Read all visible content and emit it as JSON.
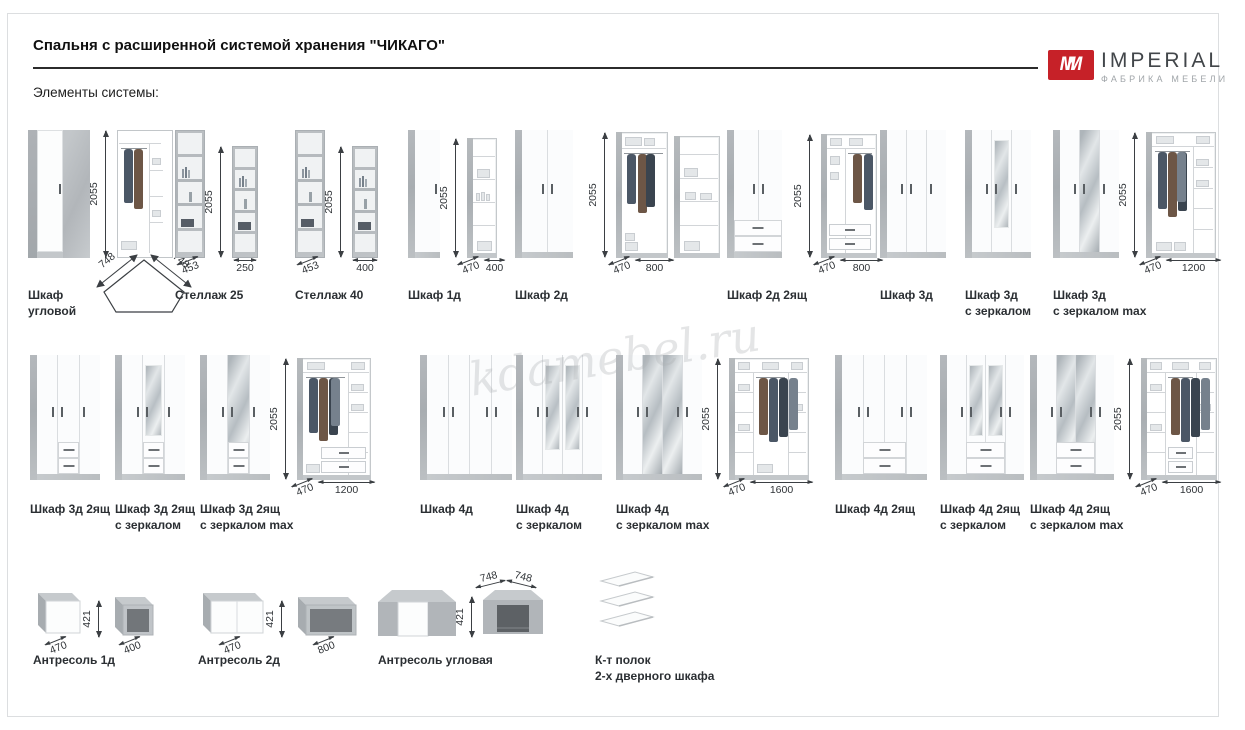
{
  "page": {
    "title": "Спальня с расширенной системой хранения \"ЧИКАГО\"",
    "subtitle": "Элементы системы:",
    "watermark": "kdamebel.ru"
  },
  "logo": {
    "monogram": "M",
    "name": "IMPERIAL",
    "tagline": "ФАБРИКА МЕБЕЛИ",
    "accent": "#c62128"
  },
  "colors": {
    "accent_red": "#c62128",
    "concrete_gray": "#b9bdc1",
    "door_white": "#fbfcfd",
    "text_dark": "#2b2f33",
    "border_gray": "#dcdee0"
  },
  "products": [
    {
      "name": [
        "Шкаф",
        "угловой"
      ],
      "height": "2055",
      "corner": [
        "748",
        "748"
      ]
    },
    {
      "name": [
        "Стеллаж 25"
      ],
      "height": "2055",
      "depth": "453",
      "width": "250"
    },
    {
      "name": [
        "Стеллаж 40"
      ],
      "height": "2055",
      "depth": "453",
      "width": "400"
    },
    {
      "name": [
        "Шкаф 1д"
      ],
      "height": "2055",
      "depth": "470",
      "width": "400"
    },
    {
      "name": [
        "Шкаф 2д"
      ],
      "height": "2055",
      "depth": "470",
      "width": "800"
    },
    {
      "name": [
        "Шкаф 2д 2ящ"
      ],
      "height": "2055",
      "depth": "470",
      "width": "800"
    },
    {
      "name": [
        "Шкаф 3д"
      ]
    },
    {
      "name": [
        "Шкаф 3д",
        "с зеркалом"
      ]
    },
    {
      "name": [
        "Шкаф 3д",
        "с зеркалом max"
      ],
      "height": "2055",
      "depth": "470",
      "width": "1200"
    },
    {
      "name": [
        "Шкаф 3д 2ящ"
      ]
    },
    {
      "name": [
        "Шкаф 3д 2ящ",
        "с зеркалом"
      ]
    },
    {
      "name": [
        "Шкаф 3д 2ящ",
        "с зеркалом max"
      ],
      "height": "2055",
      "depth": "470",
      "width": "1200"
    },
    {
      "name": [
        "Шкаф 4д"
      ]
    },
    {
      "name": [
        "Шкаф 4д",
        "с зеркалом"
      ]
    },
    {
      "name": [
        "Шкаф 4д",
        "с зеркалом max"
      ],
      "height": "2055",
      "depth": "470",
      "width": "1600"
    },
    {
      "name": [
        "Шкаф 4д 2ящ"
      ]
    },
    {
      "name": [
        "Шкаф 4д 2ящ",
        "с зеркалом"
      ]
    },
    {
      "name": [
        "Шкаф 4д 2ящ",
        "с зеркалом max"
      ],
      "height": "2055",
      "depth": "470",
      "width": "1600"
    },
    {
      "name": [
        "Антресоль 1д"
      ],
      "height": "421",
      "depth": "470",
      "width": "400"
    },
    {
      "name": [
        "Антресоль 2д"
      ],
      "height": "421",
      "depth": "470",
      "width": "800"
    },
    {
      "name": [
        "Антресоль угловая"
      ],
      "height": "421",
      "top": [
        "748",
        "748"
      ]
    },
    {
      "name": [
        "К-т полок",
        "2-х дверного шкафа"
      ]
    }
  ]
}
